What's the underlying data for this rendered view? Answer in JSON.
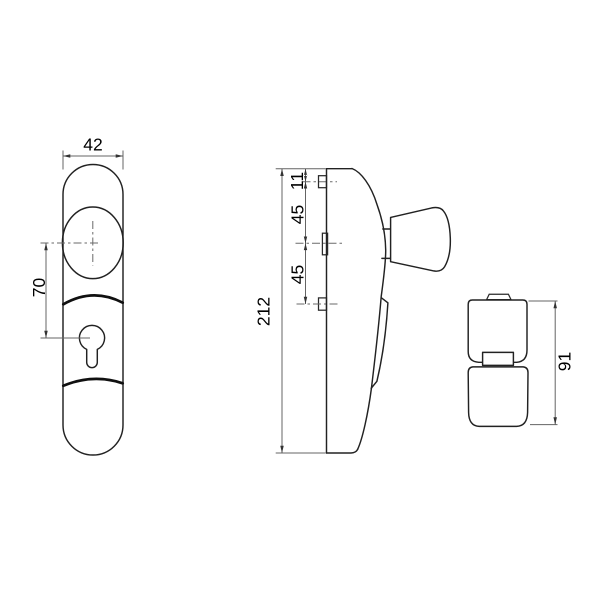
{
  "drawing": {
    "kind": "technical-orthographic-drawing",
    "subject": "door security fitting with fixed knob and euro profile cylinder hole",
    "background": "#ffffff",
    "line_color": "#222222",
    "dim_color": "#646464",
    "views": {
      "front": {
        "name": "front view of plate",
        "width_dim": "42",
        "center_distance_dim": "70"
      },
      "side": {
        "name": "side profile view",
        "height_dim": "212",
        "offset_top_dim": "11",
        "offset_mid_dim": "45",
        "offset_bottom_dim": "45"
      },
      "knob": {
        "name": "knob detail view",
        "projection_dim": "91"
      }
    }
  }
}
